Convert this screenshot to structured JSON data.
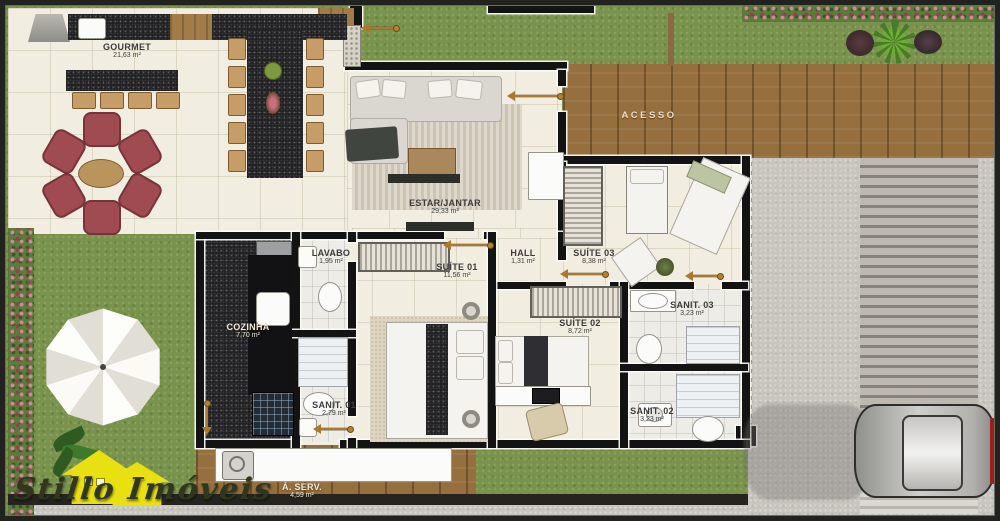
{
  "plan": {
    "rooms": [
      {
        "name": "GOURMET",
        "area": "21,63 m²"
      },
      {
        "name": "ESTAR/JANTAR",
        "area": "29,33 m²"
      },
      {
        "name": "LAVABO",
        "area": "1,95 m²"
      },
      {
        "name": "SUÍTE 01",
        "area": "11,56 m²"
      },
      {
        "name": "HALL",
        "area": "1,31  m²"
      },
      {
        "name": "SUÍTE 03",
        "area": "8,38 m²"
      },
      {
        "name": "COZINHA",
        "area": "7,70 m²"
      },
      {
        "name": "SUÍTE 02",
        "area": "8,72  m²"
      },
      {
        "name": "SANIT. 03",
        "area": "3,23 m²"
      },
      {
        "name": "SANIT. 01",
        "area": "2,79 m²"
      },
      {
        "name": "SANIT. 02",
        "area": "3,23  m²"
      },
      {
        "name": "Á. SERV.",
        "area": "4,59 m²"
      }
    ],
    "outdoor_labels": {
      "acesso": "ACESSO"
    },
    "watermark": {
      "brand": "Stillo Imóveis"
    },
    "colors": {
      "floor": "#f2ede1",
      "grass": "#79934d",
      "deck": "#956f3e",
      "wall": "#131313",
      "concrete": "#c8c5bf",
      "lounge_chair": "#9f4b51",
      "logo_yellow": "#e9e012"
    }
  }
}
